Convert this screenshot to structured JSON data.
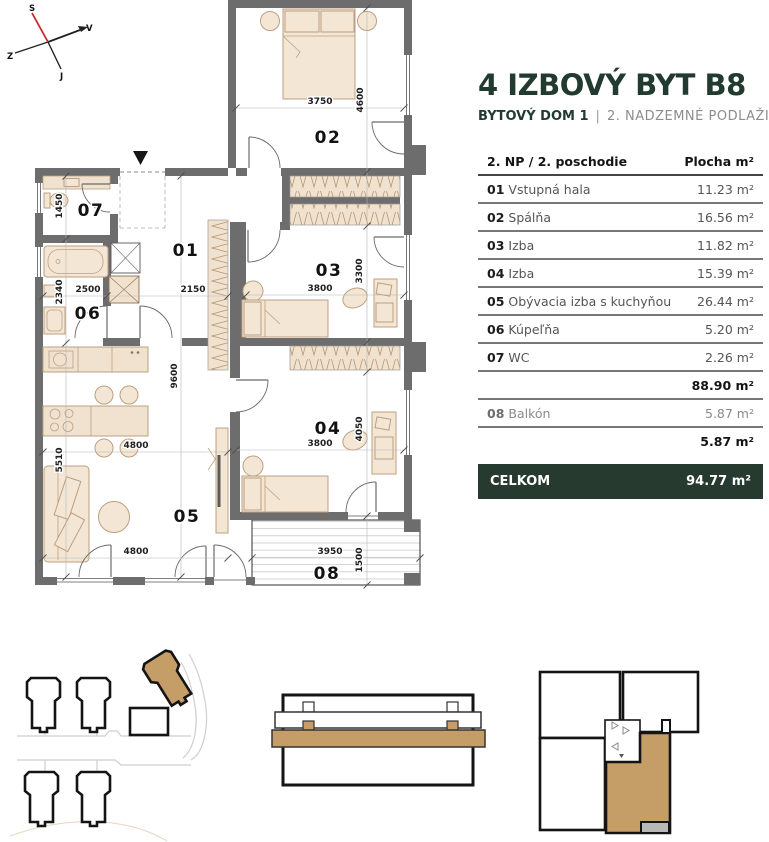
{
  "header": {
    "title": "4 IZBOVÝ BYT B8",
    "building": "BYTOVÝ DOM 1",
    "separator": "|",
    "floor": "2. NADZEMNÉ PODLAŽIE"
  },
  "compass": {
    "north": "S",
    "west": "Z",
    "east": "V",
    "south": "J"
  },
  "table": {
    "header": {
      "left": "2. NP / 2. poschodie",
      "right": "Plocha m²"
    },
    "rows": [
      {
        "num": "01",
        "name": "Vstupná hala",
        "area": "11.23 m²"
      },
      {
        "num": "02",
        "name": "Spálňa",
        "area": "16.56 m²"
      },
      {
        "num": "03",
        "name": "Izba",
        "area": "11.82 m²"
      },
      {
        "num": "04",
        "name": "Izba",
        "area": "15.39 m²"
      },
      {
        "num": "05",
        "name": "Obývacia izba s kuchyňou",
        "area": "26.44 m²"
      },
      {
        "num": "06",
        "name": "Kúpeľňa",
        "area": "5.20 m²"
      },
      {
        "num": "07",
        "name": "WC",
        "area": "2.26 m²"
      }
    ],
    "subtotal_interior": "88.90 m²",
    "balcony_row": {
      "num": "08",
      "name": "Balkón",
      "area": "5.87 m²"
    },
    "subtotal_balcony": "5.87 m²",
    "total": {
      "label": "CELKOM",
      "value": "94.77 m²"
    }
  },
  "plan": {
    "room_labels": {
      "r01": "01",
      "r02": "02",
      "r03": "03",
      "r04": "04",
      "r05": "05",
      "r06": "06",
      "r07": "07",
      "r08": "08"
    },
    "dimensions": {
      "d3750": "3750",
      "d4600": "4600",
      "d1450": "1450",
      "d2340": "2340",
      "d2500": "2500",
      "d2150": "2150",
      "d9600": "9600",
      "d5510": "5510",
      "d4800a": "4800",
      "d4800b": "4800",
      "d3800a": "3800",
      "d3300": "3300",
      "d3800b": "3800",
      "d4050": "4050",
      "d3950": "3950",
      "d1500": "1500"
    }
  },
  "colors": {
    "accent_green": "#263a30",
    "wall_gray": "#6d6d6d",
    "furniture_tan": "#f4e6d4",
    "highlight_tan": "#c59d67",
    "text_muted": "#8c8c8c"
  }
}
